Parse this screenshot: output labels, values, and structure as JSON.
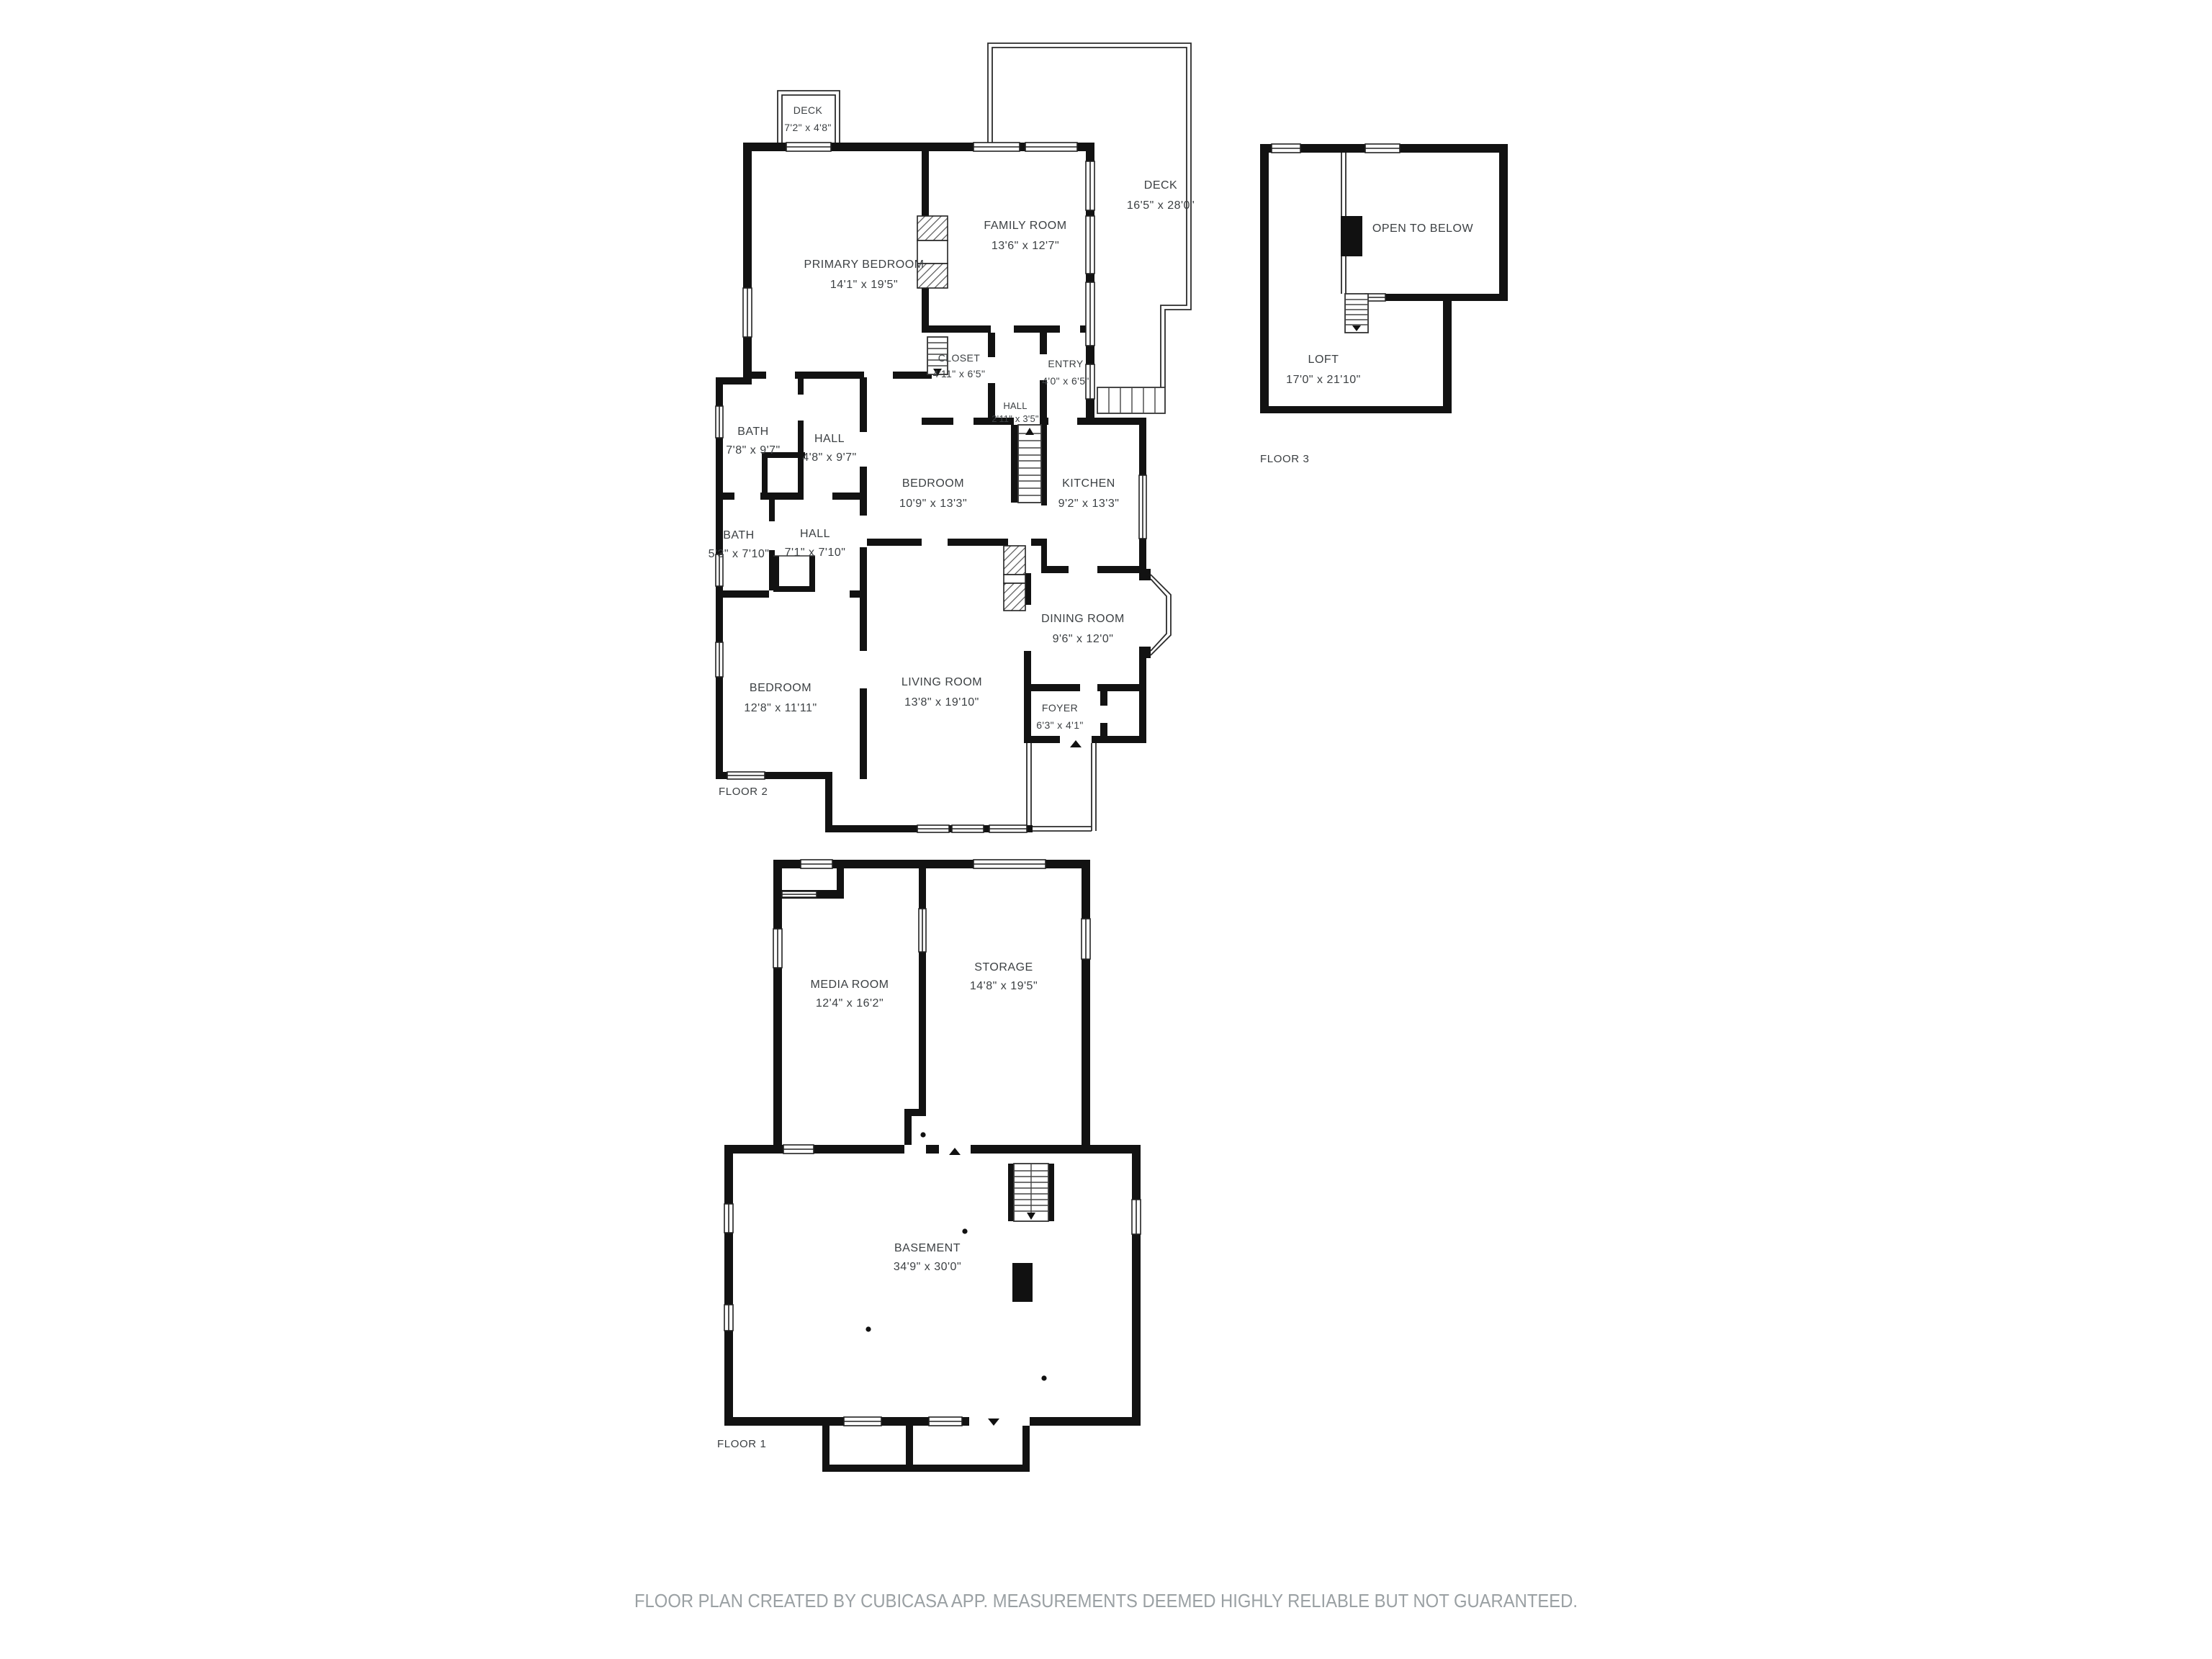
{
  "page": {
    "background": "#ffffff"
  },
  "colors": {
    "wall": "#121212",
    "label": "#3c4043",
    "footer": "#9aa0a3"
  },
  "footer": {
    "text": "FLOOR PLAN CREATED BY CUBICASA APP. MEASUREMENTS DEEMED HIGHLY RELIABLE BUT NOT GUARANTEED."
  },
  "floors": [
    {
      "label": "FLOOR 2",
      "rooms": [
        {
          "name": "DECK",
          "dims": "7'2\" x 4'8\""
        },
        {
          "name": "PRIMARY BEDROOM",
          "dims": "14'1\" x 19'5\""
        },
        {
          "name": "FAMILY ROOM",
          "dims": "13'6\" x 12'7\""
        },
        {
          "name": "DECK",
          "dims": "16'5\" x 28'0\""
        },
        {
          "name": "CLOSET",
          "dims": "4'11\" x 6'5\""
        },
        {
          "name": "ENTRY",
          "dims": "4'0\" x 6'5\""
        },
        {
          "name": "BATH",
          "dims": "7'8\" x 9'7\""
        },
        {
          "name": "HALL",
          "dims": "4'8\" x 9'7\""
        },
        {
          "name": "BEDROOM",
          "dims": "10'9\" x 13'3\""
        },
        {
          "name": "HALL",
          "dims": "2'11\" x 3'5\""
        },
        {
          "name": "KITCHEN",
          "dims": "9'2\" x 13'3\""
        },
        {
          "name": "BATH",
          "dims": "5'3\" x 7'10\""
        },
        {
          "name": "HALL",
          "dims": "7'1\" x 7'10\""
        },
        {
          "name": "BEDROOM",
          "dims": "12'8\" x 11'11\""
        },
        {
          "name": "LIVING ROOM",
          "dims": "13'8\" x 19'10\""
        },
        {
          "name": "DINING ROOM",
          "dims": "9'6\" x 12'0\""
        },
        {
          "name": "FOYER",
          "dims": "6'3\" x 4'1\""
        }
      ]
    },
    {
      "label": "FLOOR 3",
      "rooms": [
        {
          "name": "OPEN TO BELOW",
          "dims": ""
        },
        {
          "name": "LOFT",
          "dims": "17'0\" x 21'10\""
        }
      ]
    },
    {
      "label": "FLOOR 1",
      "rooms": [
        {
          "name": "MEDIA ROOM",
          "dims": "12'4\" x 16'2\""
        },
        {
          "name": "STORAGE",
          "dims": "14'8\" x 19'5\""
        },
        {
          "name": "BASEMENT",
          "dims": "34'9\" x 30'0\""
        }
      ]
    }
  ]
}
